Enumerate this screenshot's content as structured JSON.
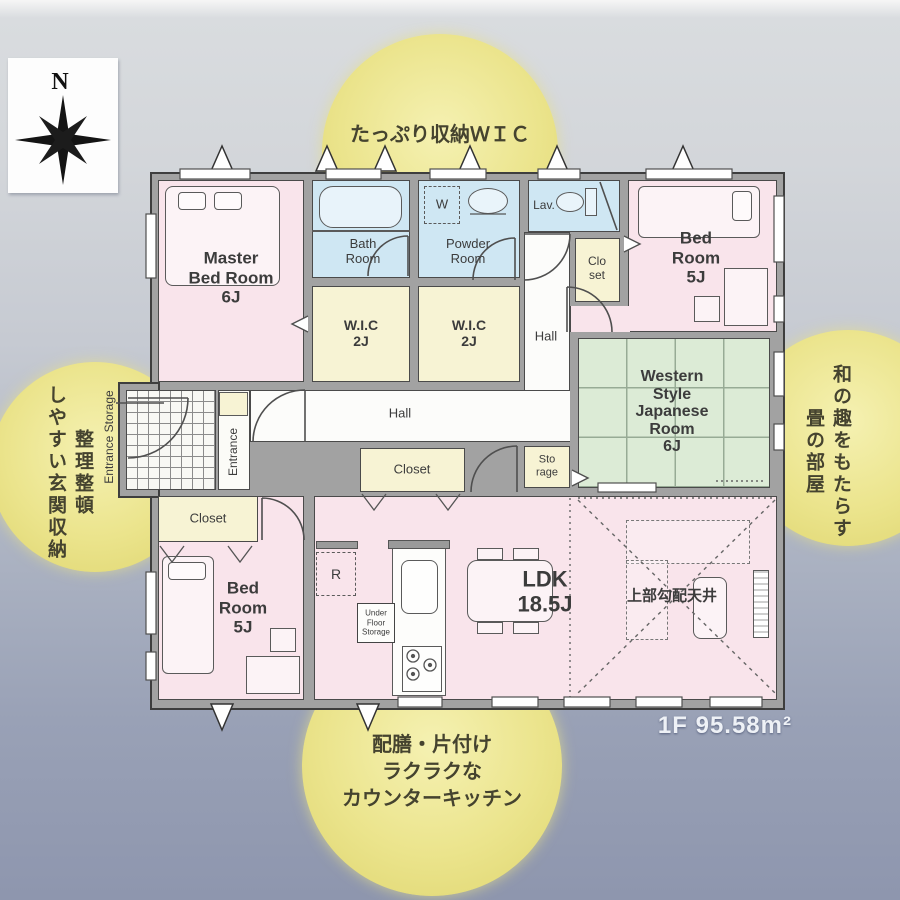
{
  "compass": {
    "north": "N"
  },
  "callouts": {
    "top": "たっぷり収納ＷＩＣ",
    "left": [
      "整理整頓",
      "しやすい玄関収納"
    ],
    "right": [
      "和の趣をもたらす",
      "畳の部屋"
    ],
    "bottom": [
      "配膳・片付け",
      "ラクラクな",
      "カウンターキッチン"
    ]
  },
  "floor_summary": "1F 95.58m²",
  "rooms": {
    "master": [
      "Master",
      "Bed Room",
      "6J"
    ],
    "bath": [
      "Bath",
      "Room"
    ],
    "powder": [
      "Powder",
      "Room"
    ],
    "lav": "Lav.",
    "bedroom_ne": [
      "Bed",
      "Room",
      "5J"
    ],
    "closet_n": [
      "Clo",
      "set"
    ],
    "wic_a": [
      "W.I.C",
      "2J"
    ],
    "wic_b": [
      "W.I.C",
      "2J"
    ],
    "hall_upper": "Hall",
    "hall_lower": "Hall",
    "japanese": [
      "Western",
      "Style",
      "Japanese",
      "Room",
      "6J"
    ],
    "storage": [
      "Sto",
      "rage"
    ],
    "closet_mid": "Closet",
    "closet_sw": "Closet",
    "bedroom_sw": [
      "Bed",
      "Room",
      "5J"
    ],
    "ldk": [
      "LDK",
      "18.5J"
    ],
    "sloped_ceiling": "上部勾配天井",
    "entrance": "Entrance",
    "entrance_storage": "Entrance Storage",
    "under_floor_storage": [
      "Under",
      "Floor",
      "Storage"
    ],
    "washer": "W",
    "fridge": "R"
  },
  "colors": {
    "bedroom_pink": "#f9e4eb",
    "wet_blue": "#cfe7f3",
    "closet_cream": "#f7f3d4",
    "tatami_green": "#dcebd6",
    "wall_gray": "#a2a2a2",
    "callout_yellow": "#ebe48c"
  }
}
